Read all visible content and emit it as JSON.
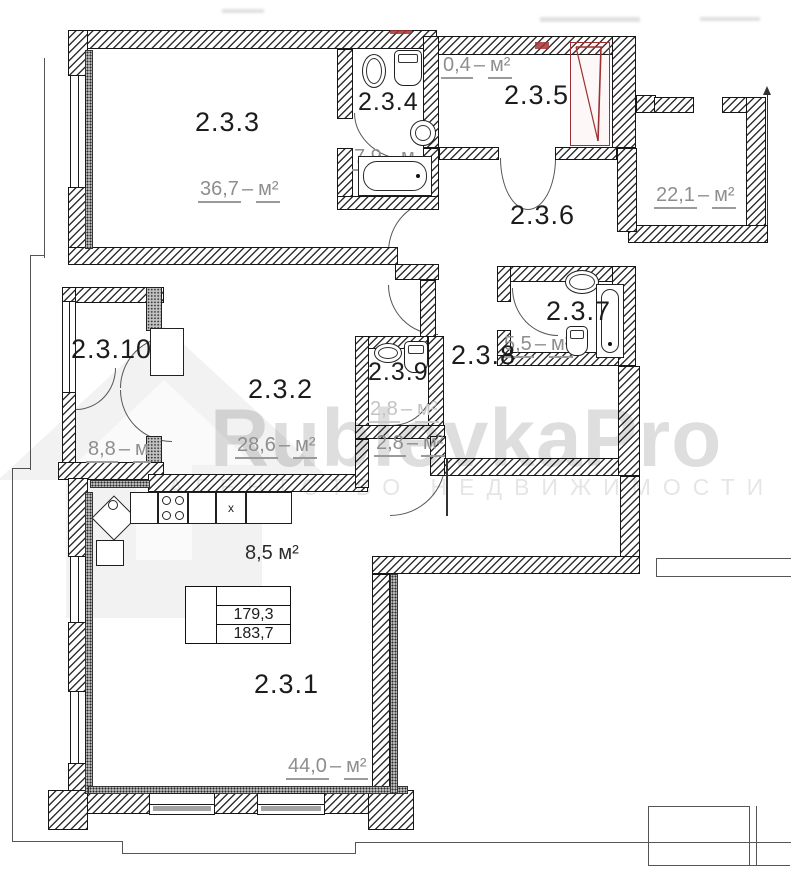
{
  "watermark": {
    "brand": "RublevkaPro",
    "subtitle": "АГЕНТСТВО НЕДВИЖИМОСТИ"
  },
  "fmt": {
    "area_dash": "–"
  },
  "rooms": {
    "r1": {
      "label": "2.3.1",
      "num": "44,0",
      "unit": "м²"
    },
    "r2": {
      "label": "2.3.2",
      "num": "28,6",
      "unit": "м²"
    },
    "r3": {
      "label": "2.3.3",
      "num": "36,7",
      "unit": "м²"
    },
    "r4": {
      "label": "2.3.4",
      "num": "7,9",
      "unit": "м"
    },
    "r5": {
      "label": "2.3.5",
      "num": "0,4",
      "unit": "м²"
    },
    "r6": {
      "label": "2.3.6",
      "num": "22,1",
      "unit": "м²"
    },
    "r7": {
      "label": "2.3.7",
      "num": "5,5",
      "unit": "м²"
    },
    "r8": {
      "label": "2.3.8"
    },
    "r9": {
      "label": "2.3.9",
      "num": "2,8",
      "unit": "м²"
    },
    "r10": {
      "label": "2.3.10",
      "num": "8,8",
      "unit": "м"
    },
    "hall": {
      "num": "2,8",
      "unit": "м²"
    }
  },
  "kitchen": {
    "area": "8,5 м²",
    "marker": "x"
  },
  "summary": {
    "row1": "179,3",
    "row2": "183,7"
  }
}
